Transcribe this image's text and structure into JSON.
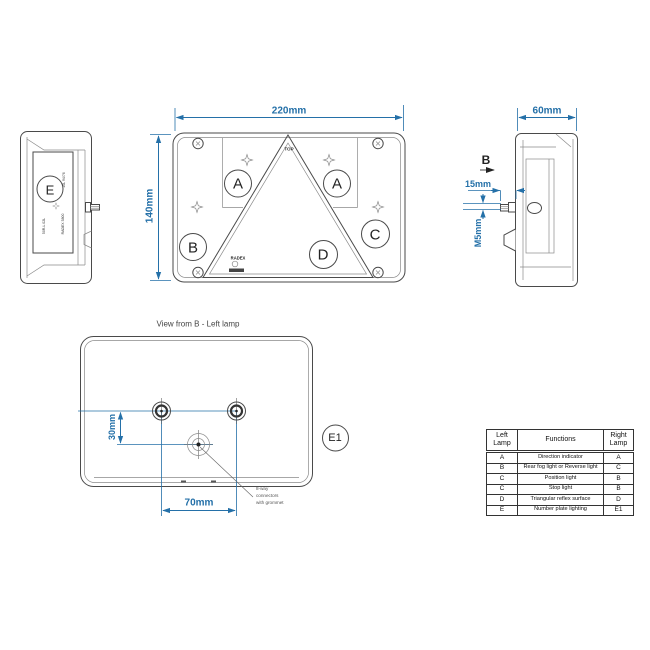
{
  "colors": {
    "dimension_blue": "#2470a8",
    "line_gray": "#4a4a4a"
  },
  "front_view": {
    "width_label": "220mm",
    "height_label": "140mm",
    "top_label": "TOP",
    "brand": "RADEX",
    "zones": {
      "a_left": "A",
      "a_right": "A",
      "b": "B",
      "c": "C",
      "d": "D"
    }
  },
  "left_side_view": {
    "e_mark": "E",
    "markings": [
      "10L 94/76",
      "RADEX 5800",
      "50R-L 02L"
    ]
  },
  "right_side_view": {
    "depth_label": "60mm",
    "view_arrow_label": "B",
    "stud_length_label": "15mm",
    "thread_label": "M5mm"
  },
  "view_from_b": {
    "title": "View from B  - Left lamp",
    "offset_label": "30mm",
    "spacing_label": "70mm",
    "e1_mark": "E1",
    "note_lines": [
      "8-way",
      "connectors",
      "with grommet"
    ]
  },
  "table": {
    "headers": [
      "Left Lamp",
      "Functions",
      "Right Lamp"
    ],
    "rows": [
      [
        "A",
        "Direction indicator",
        "A"
      ],
      [
        "B",
        "Rear fog light or Reverse light",
        "C"
      ],
      [
        "C",
        "Position light",
        "B"
      ],
      [
        "C",
        "Stop light",
        "B"
      ],
      [
        "D",
        "Triangular reflex surface",
        "D"
      ],
      [
        "E",
        "Number plate lighting",
        "E1"
      ]
    ]
  }
}
